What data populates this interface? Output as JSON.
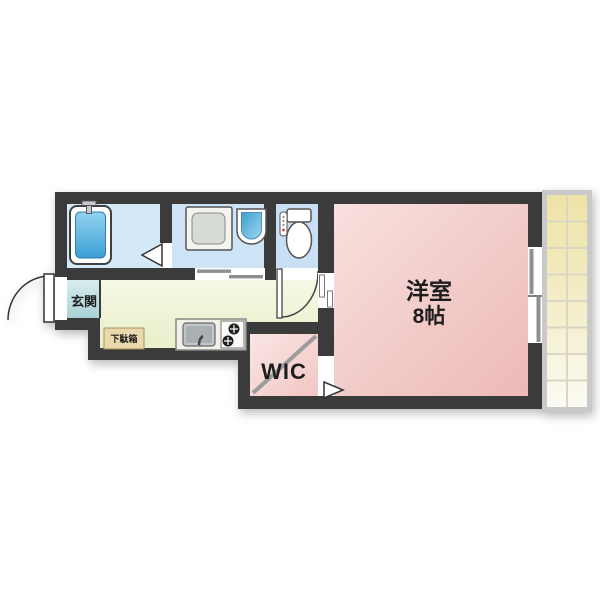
{
  "floorplan": {
    "labels": {
      "entrance": "玄関",
      "shoe_cabinet": "下駄箱",
      "walk_in_closet": "WIC",
      "western_room": "洋室",
      "western_room_size": "8帖"
    },
    "colors": {
      "wall": "#3b3b3b",
      "bathroom_floor": "#d3e9f7",
      "washroom_floor": "#cde3f6",
      "toilet_floor": "#c9e0f4",
      "kitchen_floor": "#eef3d3",
      "entrance_floor": "#bfdde0",
      "wic_floor": "#f6d9d7",
      "western_room_floor": "#f1c6c4",
      "balcony_floor": "#efe5ad",
      "bathtub": "#4facdb",
      "shoe_cabinet": "#ead9ae"
    }
  }
}
